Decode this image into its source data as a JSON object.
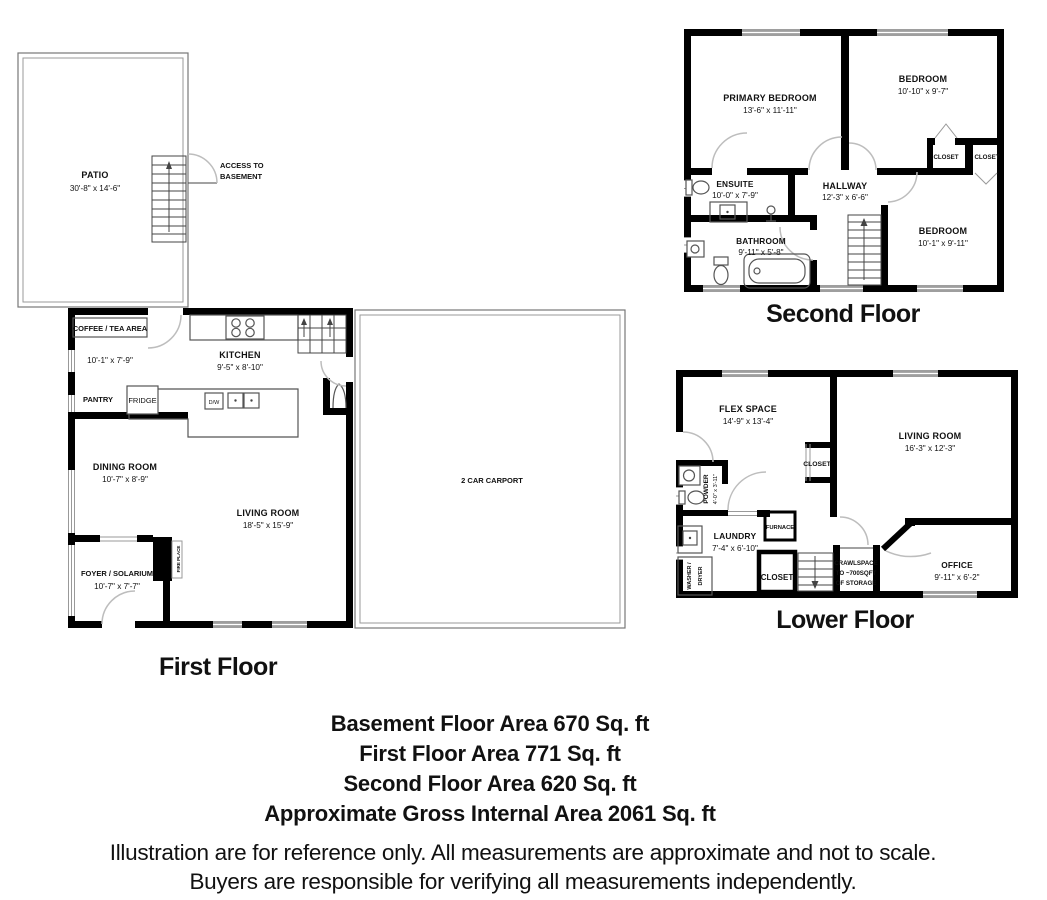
{
  "colors": {
    "wall": "#000000",
    "window_fill": "#9e9e9e",
    "door_arc": "#bdbdbd",
    "background": "#ffffff"
  },
  "first_floor": {
    "title": "First Floor",
    "patio": {
      "label": "PATIO",
      "dims": "30'-8\" x 14'-6\""
    },
    "access_to_basement": {
      "line1": "ACCESS TO",
      "line2": "BASEMENT"
    },
    "coffee_tea": {
      "label": "COFFEE / TEA AREA",
      "dims": "10'-1\" x 7'-9\""
    },
    "kitchen": {
      "label": "KITCHEN",
      "dims": "9'-5\" x 8'-10\""
    },
    "pantry": {
      "label": "PANTRY"
    },
    "fridge": {
      "label": "FRIDGE"
    },
    "dishwasher": {
      "label": "D/W"
    },
    "dining": {
      "label": "DINING ROOM",
      "dims": "10'-7\" x 8'-9\""
    },
    "living": {
      "label": "LIVING ROOM",
      "dims": "18'-5\" x 15'-9\""
    },
    "foyer": {
      "label": "FOYER / SOLARIUM",
      "dims": "10'-7\"  x 7'-7\""
    },
    "fireplace": {
      "label": "FIRE PLACE"
    },
    "carport": {
      "label": "2 CAR CARPORT"
    }
  },
  "second_floor": {
    "title": "Second Floor",
    "primary_bedroom": {
      "label": "PRIMARY BEDROOM",
      "dims": "13'-6\" x 11'-11\""
    },
    "bedroom_right": {
      "label": "BEDROOM",
      "dims": "10'-10\" x 9'-7\""
    },
    "closet_left": {
      "label": "CLOSET"
    },
    "closet_right": {
      "label": "CLOSET"
    },
    "ensuite": {
      "label": "ENSUITE",
      "dims": "10'-0\" x 7'-9\""
    },
    "hallway": {
      "label": "HALLWAY",
      "dims": "12'-3\" x 6'-6\""
    },
    "bathroom": {
      "label": "BATHROOM",
      "dims": "9'-11\" x 5'-8\""
    },
    "bedroom_lower": {
      "label": "BEDROOM",
      "dims": "10'-1\" x 9'-11\""
    }
  },
  "lower_floor": {
    "title": "Lower Floor",
    "flex_space": {
      "label": "FLEX SPACE",
      "dims": "14'-9\" x 13'-4\""
    },
    "living_room": {
      "label": "LIVING ROOM",
      "dims": "16'-3\" x 12'-3\""
    },
    "closet_mid": {
      "label": "CLOSET"
    },
    "powder": {
      "label": "POWDER",
      "dims": "4'-0\" x 3'-11\""
    },
    "laundry": {
      "label": "LAUNDRY",
      "dims": "7'-4\" x 6'-10\""
    },
    "furnace": {
      "label": "FURNACE"
    },
    "closet_bottom": {
      "label": "CLOSET"
    },
    "crawlspace": {
      "line1": "CRAWLSPACE",
      "line2": "TO ~700SQFT",
      "line3": "OF STORAGE"
    },
    "office": {
      "label": "OFFICE",
      "dims": "9'-11\" x 6'-2\""
    },
    "washer_dryer": {
      "line1": "WASHER /",
      "line2": "DRYER"
    }
  },
  "summary": {
    "basement": "Basement Floor Area 670 Sq. ft",
    "first": "First Floor Area 771 Sq. ft",
    "second": "Second Floor Area 620 Sq. ft",
    "gross": "Approximate Gross Internal Area 2061 Sq. ft"
  },
  "disclaimer": {
    "line1": "Illustration are for reference only. All measurements are approximate and not to scale.",
    "line2": "Buyers are responsible for verifying all measurements independently."
  }
}
